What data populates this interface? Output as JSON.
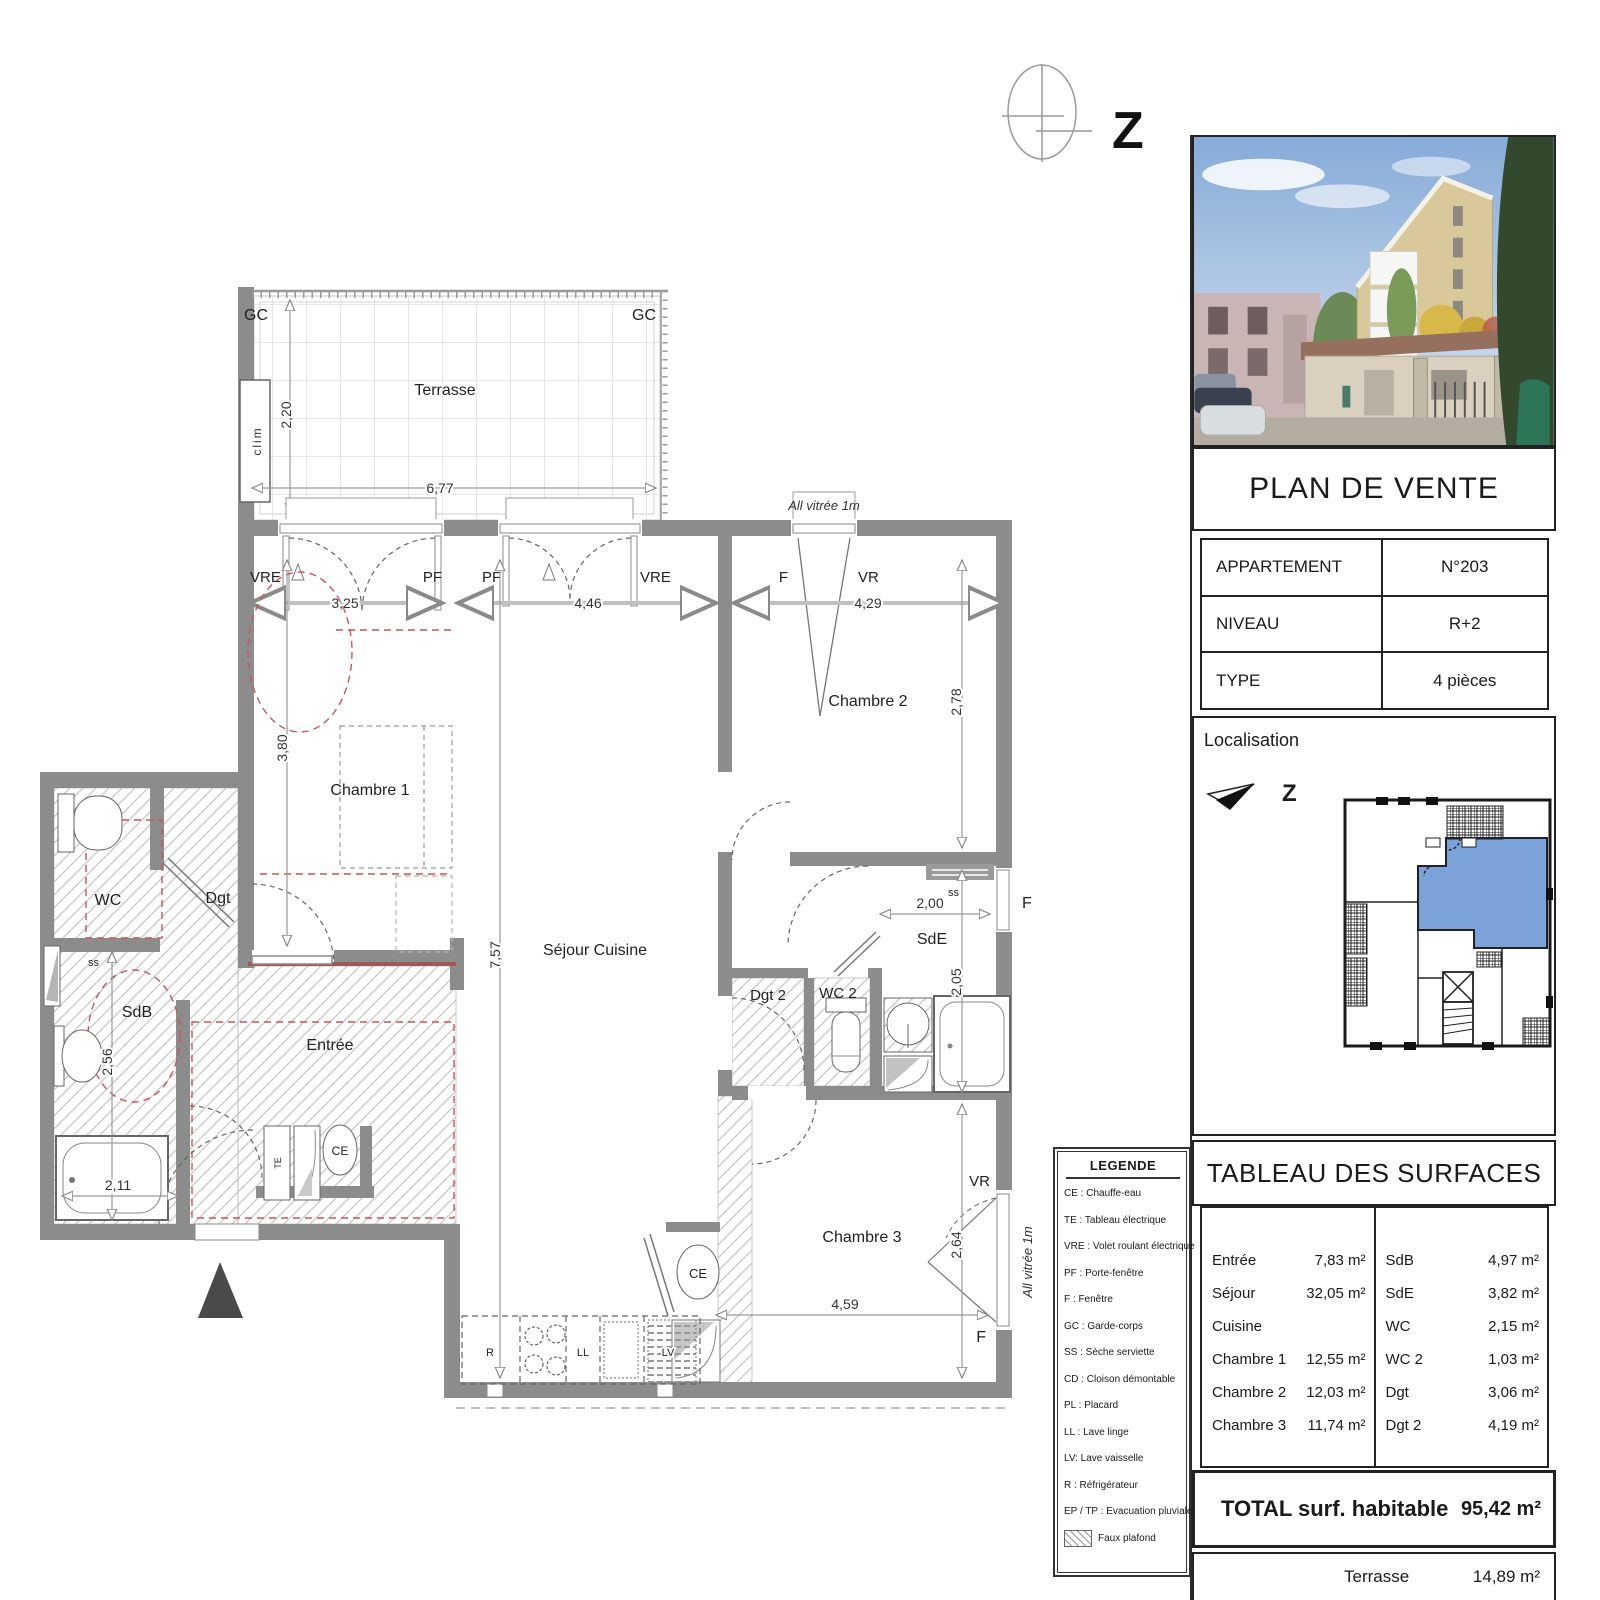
{
  "compass": {
    "label": "Z"
  },
  "plan": {
    "terrasse": {
      "label": "Terrasse",
      "gc_left": "GC",
      "gc_right": "GC",
      "clim": "clim",
      "dim_h": "2,20",
      "dim_w": "6,77"
    },
    "top_windows": {
      "note": "All vitrée 1m",
      "w1_l": "VRE",
      "w1_r": "PF",
      "w1_dim": "3,25",
      "w2_l": "PF",
      "w2_r": "VRE",
      "w2_dim": "4,46",
      "w3_l": "F",
      "w3_r": "VR",
      "w3_dim": "4,29"
    },
    "chambre1": {
      "label": "Chambre 1",
      "dim": "3,80"
    },
    "sejour": {
      "label": "Séjour Cuisine",
      "dim": "7,57",
      "r": "R",
      "ll": "LL",
      "lv": "LV",
      "ce": "CE"
    },
    "chambre2": {
      "label": "Chambre 2",
      "dim": "2,78"
    },
    "sde": {
      "label": "SdE",
      "dim": "2,05",
      "dim_w": "2,00",
      "ss": "ss",
      "window": "F"
    },
    "dgt2": {
      "label": "Dgt 2"
    },
    "wc2": {
      "label": "WC 2"
    },
    "chambre3": {
      "label": "Chambre 3",
      "dim_v": "2,64",
      "dim_w": "4,59",
      "vr": "VR",
      "f": "F",
      "note": "All vitrée 1m"
    },
    "wc": {
      "label": "WC"
    },
    "dgt": {
      "label": "Dgt"
    },
    "sdb": {
      "label": "SdB",
      "ss": "ss",
      "dim_v": "2,56",
      "dim_w": "2,11"
    },
    "entree": {
      "label": "Entrée",
      "te": "TE",
      "ce": "CE"
    }
  },
  "panel": {
    "title": "PLAN DE VENTE",
    "info": [
      {
        "label": "APPARTEMENT",
        "value": "N°203"
      },
      {
        "label": "NIVEAU",
        "value": "R+2"
      },
      {
        "label": "TYPE",
        "value": "4 pièces"
      }
    ],
    "localisation": {
      "title": "Localisation",
      "north": "Z"
    },
    "surfaces": {
      "title": "TABLEAU DES SURFACES",
      "left": [
        {
          "room": "Entrée",
          "area": "7,83 m²"
        },
        {
          "room": "Séjour Cuisine",
          "area": "32,05 m²"
        },
        {
          "room": "Chambre 1",
          "area": "12,55 m²"
        },
        {
          "room": "Chambre 2",
          "area": "12,03 m²"
        },
        {
          "room": "Chambre 3",
          "area": "11,74 m²"
        }
      ],
      "right": [
        {
          "room": "SdB",
          "area": "4,97 m²"
        },
        {
          "room": "SdE",
          "area": "3,82 m²"
        },
        {
          "room": "WC",
          "area": "2,15 m²"
        },
        {
          "room": "WC 2",
          "area": "1,03 m²"
        },
        {
          "room": "Dgt",
          "area": "3,06 m²"
        },
        {
          "room": "Dgt 2",
          "area": "4,19 m²"
        }
      ],
      "total_label": "TOTAL surf. habitable",
      "total_value": "95,42 m²",
      "terrasse_label": "Terrasse",
      "terrasse_value": "14,89 m²"
    }
  },
  "legend": {
    "title": "LEGENDE",
    "items": [
      "CE : Chauffe-eau",
      "TE : Tableau électrique",
      "VRE : Volet roulant électrique",
      "PF : Porte-fenêtre",
      "F : Fenêtre",
      "GC : Garde-corps",
      "SS : Sèche serviette",
      "CD : Cloison démontable",
      "PL : Placard",
      "LL : Lave linge",
      "LV: Lave vaisselle",
      "R : Réfrigérateur",
      "EP / TP : Evacuation pluviale"
    ],
    "hatch_label": "Faux plafond"
  },
  "colors": {
    "wall": "#8c8c8c",
    "highlight_blue": "#7ba3d9",
    "red_dash": "#cc5555"
  }
}
